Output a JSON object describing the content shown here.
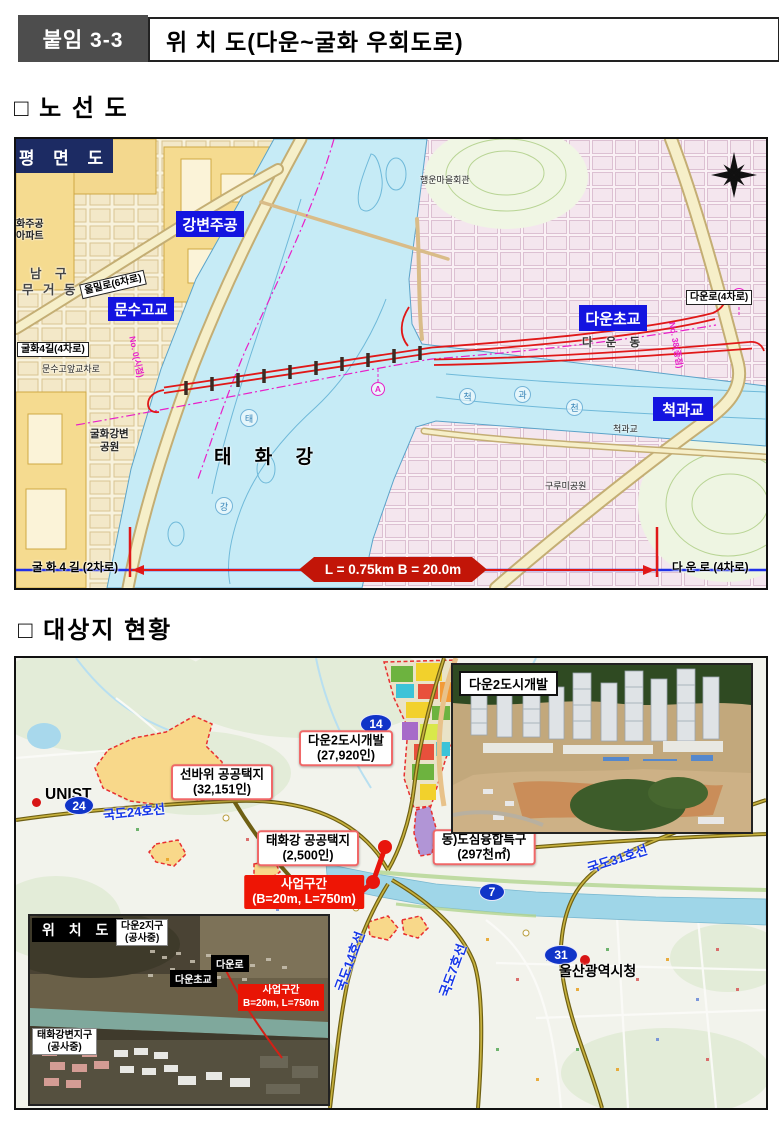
{
  "header": {
    "tag": "붙임 3-3",
    "title": "위 치 도(다운~굴화 우회도로)"
  },
  "sections": {
    "route_map": "□ 노 선 도",
    "site_status": "□ 대상지 현황"
  },
  "route_map": {
    "view_label": "평 면 도",
    "landmarks": {
      "gangbyeon_jugong": "강변주공",
      "munsu_high": "문수고교",
      "daun_elementary": "다운초교",
      "cheokgwa_bridge": "척과교"
    },
    "roads": {
      "ulmil": "울밀로(6차로)",
      "gulhwa4": "굴화4길(4차로)",
      "daun": "다운로(4차로)"
    },
    "places": {
      "apt_line1": "화주공",
      "apt_line2": "아파트",
      "nam_gu": "남 구",
      "mugeo_dong": "무 거 동",
      "munsu_crossing": "문수고앞교차로",
      "gulhwa_park_line1": "굴화강변",
      "gulhwa_park_line2": "공원",
      "taehwa_river": "태 화 강",
      "daun_dong": "다 운 동",
      "haengun_hall": "행운마을회관",
      "gurumi_park": "구루미공원",
      "cheokgwa_small": "척과교",
      "stream_chars": [
        "척",
        "과",
        "천"
      ],
      "river_chars": [
        "태",
        "강"
      ]
    },
    "stations": {
      "start": "No. 0(시점)",
      "end": "No. 38(종점)"
    },
    "dimension": {
      "left_road": "굴 화 4 길 (2차로)",
      "badge": "L = 0.75km B = 20.0m",
      "right_road": "다 운 로 (4차로)"
    }
  },
  "site_map": {
    "unist": "UNIST",
    "city_hall": "울산광역시청",
    "route_markers": {
      "r24": "24",
      "r14": "14",
      "r7": "7",
      "r31": "31"
    },
    "road_names": {
      "n24": "국도24호선",
      "n31": "국도31호선",
      "n14": "국도14호선",
      "n7": "국도7호선"
    },
    "zones": [
      {
        "name": "선바위 공공택지",
        "value": "(32,151인)"
      },
      {
        "name": "다운2도시개발",
        "value": "(27,920인)"
      },
      {
        "name": "태화강 공공택지",
        "value": "(2,500인)"
      },
      {
        "name": "동)도심융합특구",
        "value": "(297천㎡)"
      }
    ],
    "project": {
      "name": "사업구간",
      "spec": "(B=20m, L=750m)"
    },
    "photo_inset": {
      "title": "다운2도시개발"
    },
    "location_inset": {
      "title": "위 치 도",
      "daun2_district": "다운2지구",
      "daun2_status": "(공사중)",
      "daun_ro": "다운로",
      "daun_elementary": "다운초교",
      "project_name": "사업구간",
      "project_spec": "B=20m, L=750m",
      "taehwa_district": "태화강변지구",
      "taehwa_status": "(공사중)"
    }
  },
  "colors": {
    "label_blue": "#1414e0",
    "corner_navy": "#1c2b63",
    "route_red": "#e01818",
    "project_red": "#ee1505",
    "station_magenta": "#e820c8",
    "marker_blue": "#1034c8",
    "zone_border": "#f06868",
    "dimension_blue": "#2030e8",
    "header_tag_bg": "#4d4d4d"
  },
  "icons": {
    "compass": "compass-rose",
    "unist_dot": "red-dot",
    "city_hall_dot": "red-dot"
  }
}
